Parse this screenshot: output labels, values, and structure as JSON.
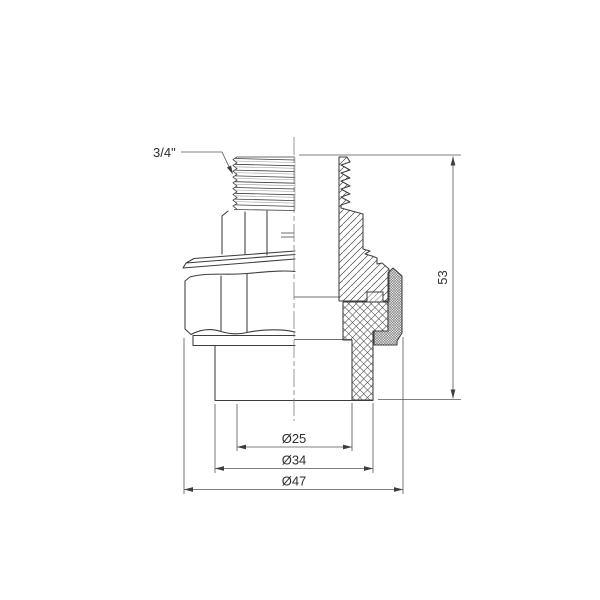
{
  "drawing": {
    "kind": "technical-drawing",
    "subject": "Union pipe fitting with male thread, half-section view",
    "background_color": "#ffffff",
    "line_color": "#3d3d3d",
    "dimension_color": "#565656",
    "annotations": {
      "thread_size": "3/4\"",
      "bore_diameter": "Ø25",
      "socket_outer_diameter": "Ø34",
      "nut_outer_diameter": "Ø47",
      "overall_height": "53"
    }
  }
}
